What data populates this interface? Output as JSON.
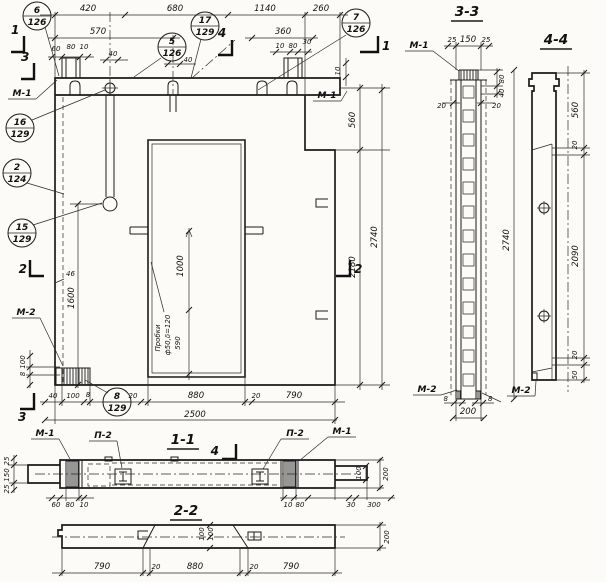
{
  "drawing": {
    "dims": {
      "v420": "420",
      "v680": "680",
      "v1140": "1140",
      "v260": "260",
      "v570": "570",
      "v360": "360",
      "v60": "60",
      "v80": "80",
      "v10": "10",
      "v40": "40",
      "v30": "30",
      "v46": "46",
      "v2500": "2500",
      "v880": "880",
      "v790": "790",
      "v20": "20",
      "v25": "25",
      "v150": "150",
      "v100": "100",
      "v8": "8",
      "v1600": "1600",
      "v1000": "1000",
      "v590": "590",
      "v560": "560",
      "v2180": "2180",
      "v2740": "2740",
      "v2090": "2090",
      "v50": "50",
      "v200": "200",
      "v300": "300"
    },
    "labels": {
      "m1": "М-1",
      "m2": "М-2",
      "p2": "П-2",
      "probki1": "Пробки",
      "probki2": "ф50,δ=120"
    },
    "sections": {
      "s11": "1-1",
      "s22": "2-2",
      "s33": "3-3",
      "s44": "4-4"
    },
    "marks": {
      "n1": "1",
      "n2": "2",
      "n3": "3",
      "n4": "4"
    },
    "callouts": [
      {
        "n": "6",
        "s": "126"
      },
      {
        "n": "17",
        "s": "129"
      },
      {
        "n": "7",
        "s": "126"
      },
      {
        "n": "5",
        "s": "126"
      },
      {
        "n": "16",
        "s": "129"
      },
      {
        "n": "2",
        "s": "124"
      },
      {
        "n": "15",
        "s": "129"
      },
      {
        "n": "8",
        "s": "129"
      }
    ]
  }
}
